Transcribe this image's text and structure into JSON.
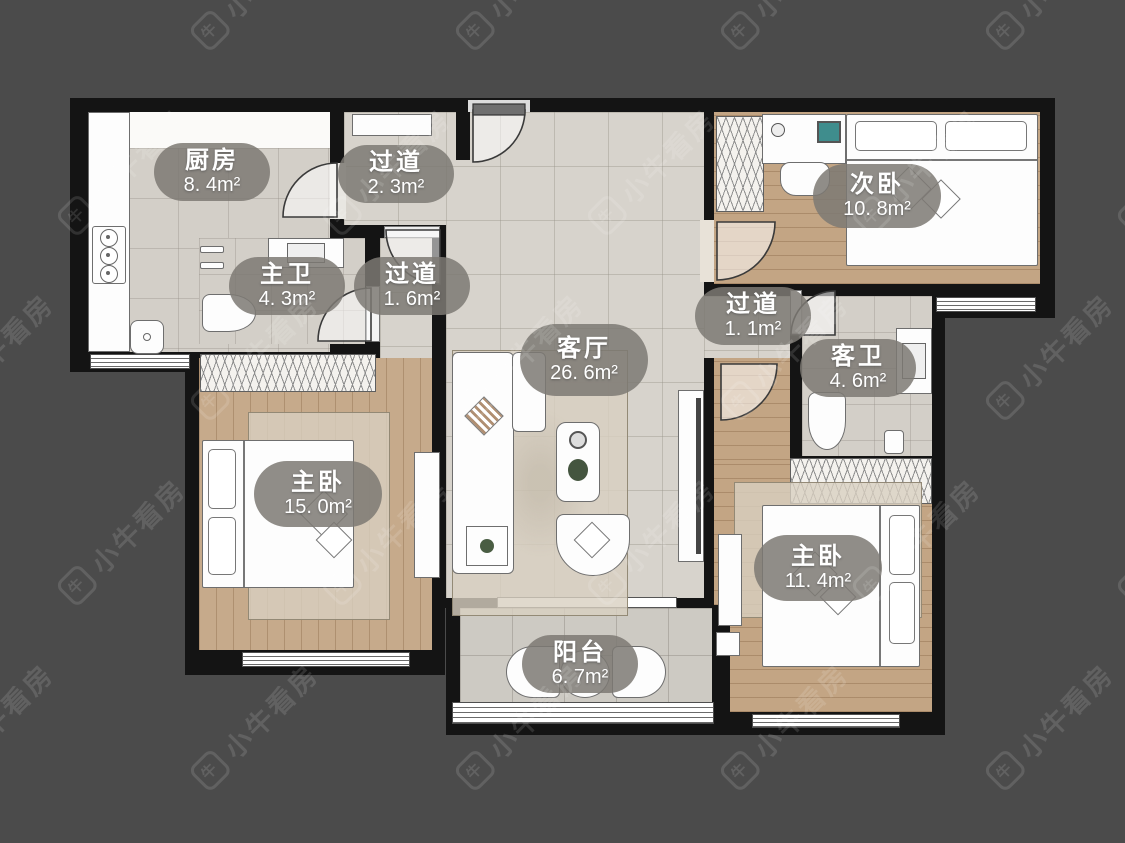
{
  "watermark": {
    "text": "小牛看房",
    "logo_char": "牛"
  },
  "rooms": [
    {
      "id": "kitchen",
      "name": "厨房",
      "area": "8. 4m²"
    },
    {
      "id": "hallway-top",
      "name": "过道",
      "area": "2. 3m²"
    },
    {
      "id": "second-bedroom",
      "name": "次卧",
      "area": "10. 8m²"
    },
    {
      "id": "master-bath",
      "name": "主卫",
      "area": "4. 3m²"
    },
    {
      "id": "hallway-mid",
      "name": "过道",
      "area": "1. 6m²"
    },
    {
      "id": "living-room",
      "name": "客厅",
      "area": "26. 6m²"
    },
    {
      "id": "hallway-right",
      "name": "过道",
      "area": "1. 1m²"
    },
    {
      "id": "guest-bath",
      "name": "客卫",
      "area": "4. 6m²"
    },
    {
      "id": "master-bedroom",
      "name": "主卧",
      "area": "15. 0m²"
    },
    {
      "id": "bedroom-right",
      "name": "主卧",
      "area": "11. 4m²"
    },
    {
      "id": "balcony",
      "name": "阳台",
      "area": "6. 7m²"
    }
  ],
  "colors": {
    "background": "#4b4b4b",
    "wall": "#141414",
    "tile_floor": "#d7d3cc",
    "wood_floor": "#c6aa8b",
    "label_pill": "#7c7973",
    "label_text": "#ffffff"
  }
}
